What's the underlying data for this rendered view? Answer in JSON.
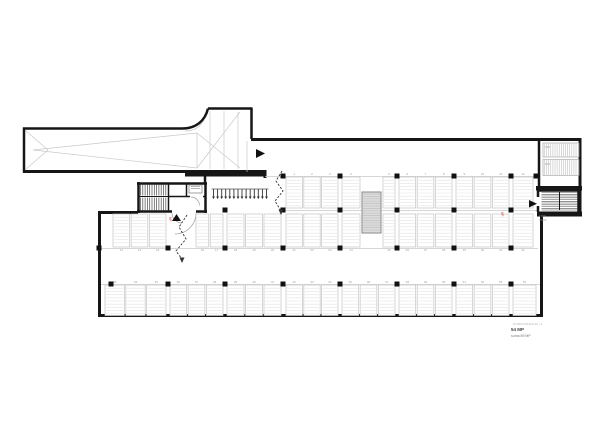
{
  "legend": {
    "note": "· KONDYGNACJA -1",
    "count": "54 MP",
    "sum": "suma 89 MP"
  },
  "small_labels": {
    "ramp_upper": "15%",
    "ramp_lower": "15%",
    "stair_right_a": "17/29",
    "stair_right_b": "h=220",
    "hydrant_left": "HP",
    "hydrant_right": "HP"
  },
  "colors": {
    "wall": "#161616",
    "stall_line": "#c2c2c2",
    "stall_hatch": "#e3e3e3",
    "column": "#111111",
    "shaft_fill": "#dcdcdc",
    "accent_red": "#d23b3b"
  },
  "parking": {
    "total_spaces_this_level": 54,
    "total_spaces_sum": 89,
    "rows": [
      {
        "id": "B",
        "y": 177,
        "h": 31,
        "label_side": "top",
        "start": 1,
        "segments": [
          [
            286,
            338
          ],
          [
            342,
            360
          ],
          [
            383,
            395
          ],
          [
            399,
            452
          ],
          [
            456,
            509
          ],
          [
            513,
            533
          ]
        ]
      },
      {
        "id": "C",
        "y": 214,
        "h": 33,
        "label_side": "bottom",
        "start": 13,
        "segments": [
          [
            113,
            166
          ],
          [
            196,
            223
          ],
          [
            227,
            281
          ],
          [
            286,
            338
          ],
          [
            342,
            360
          ],
          [
            383,
            395
          ],
          [
            399,
            452
          ],
          [
            456,
            509
          ],
          [
            513,
            533
          ]
        ]
      },
      {
        "id": "D",
        "y": 285,
        "h": 30.5,
        "label_side": "top",
        "start": 33,
        "segments": [
          [
            105,
            166
          ],
          [
            170,
            223
          ],
          [
            227,
            281
          ],
          [
            286,
            338
          ],
          [
            342,
            395
          ],
          [
            399,
            452
          ],
          [
            456,
            509
          ],
          [
            513,
            536
          ]
        ]
      }
    ]
  },
  "columns": {
    "size": 5,
    "positions": [
      {
        "y": 176,
        "xs": [
          283,
          340,
          397,
          454,
          511,
          536
        ]
      },
      {
        "y": 210,
        "xs": [
          225,
          283,
          340,
          397,
          454,
          511
        ]
      },
      {
        "y": 248,
        "xs": [
          99,
          168,
          225,
          283,
          340,
          397,
          454,
          511
        ]
      },
      {
        "y": 284,
        "xs": [
          111,
          168,
          225,
          283,
          340,
          397,
          454,
          511
        ]
      }
    ]
  },
  "bike_racks": {
    "x1": 213.5,
    "x2": 266.5,
    "count": 14,
    "y1": 189,
    "y2": 196.5
  }
}
